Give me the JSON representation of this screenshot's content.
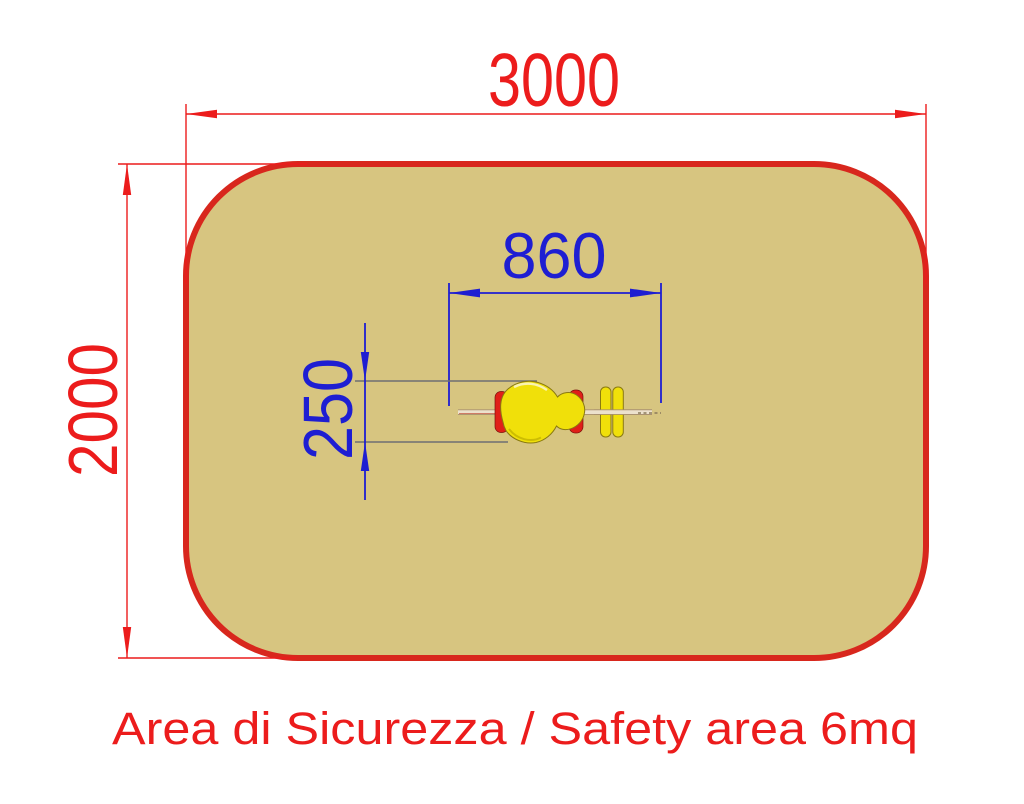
{
  "diagram": {
    "caption": "Area di Sicurezza / Safety area 6mq",
    "dims": {
      "width_label": "3000",
      "height_label": "2000",
      "toy_length_label": "860",
      "toy_width_label": "250"
    },
    "colors": {
      "red": "#EC1C1C",
      "area_border": "#D8271D",
      "area_fill": "#D7C580",
      "blue": "#1E1ED2",
      "ext_gray": "#6E6E72",
      "toy_yellow": "#F0E00A",
      "toy_red": "#E02018",
      "beam_light": "#ECE1CC",
      "beam_edge": "#A8906F"
    }
  }
}
